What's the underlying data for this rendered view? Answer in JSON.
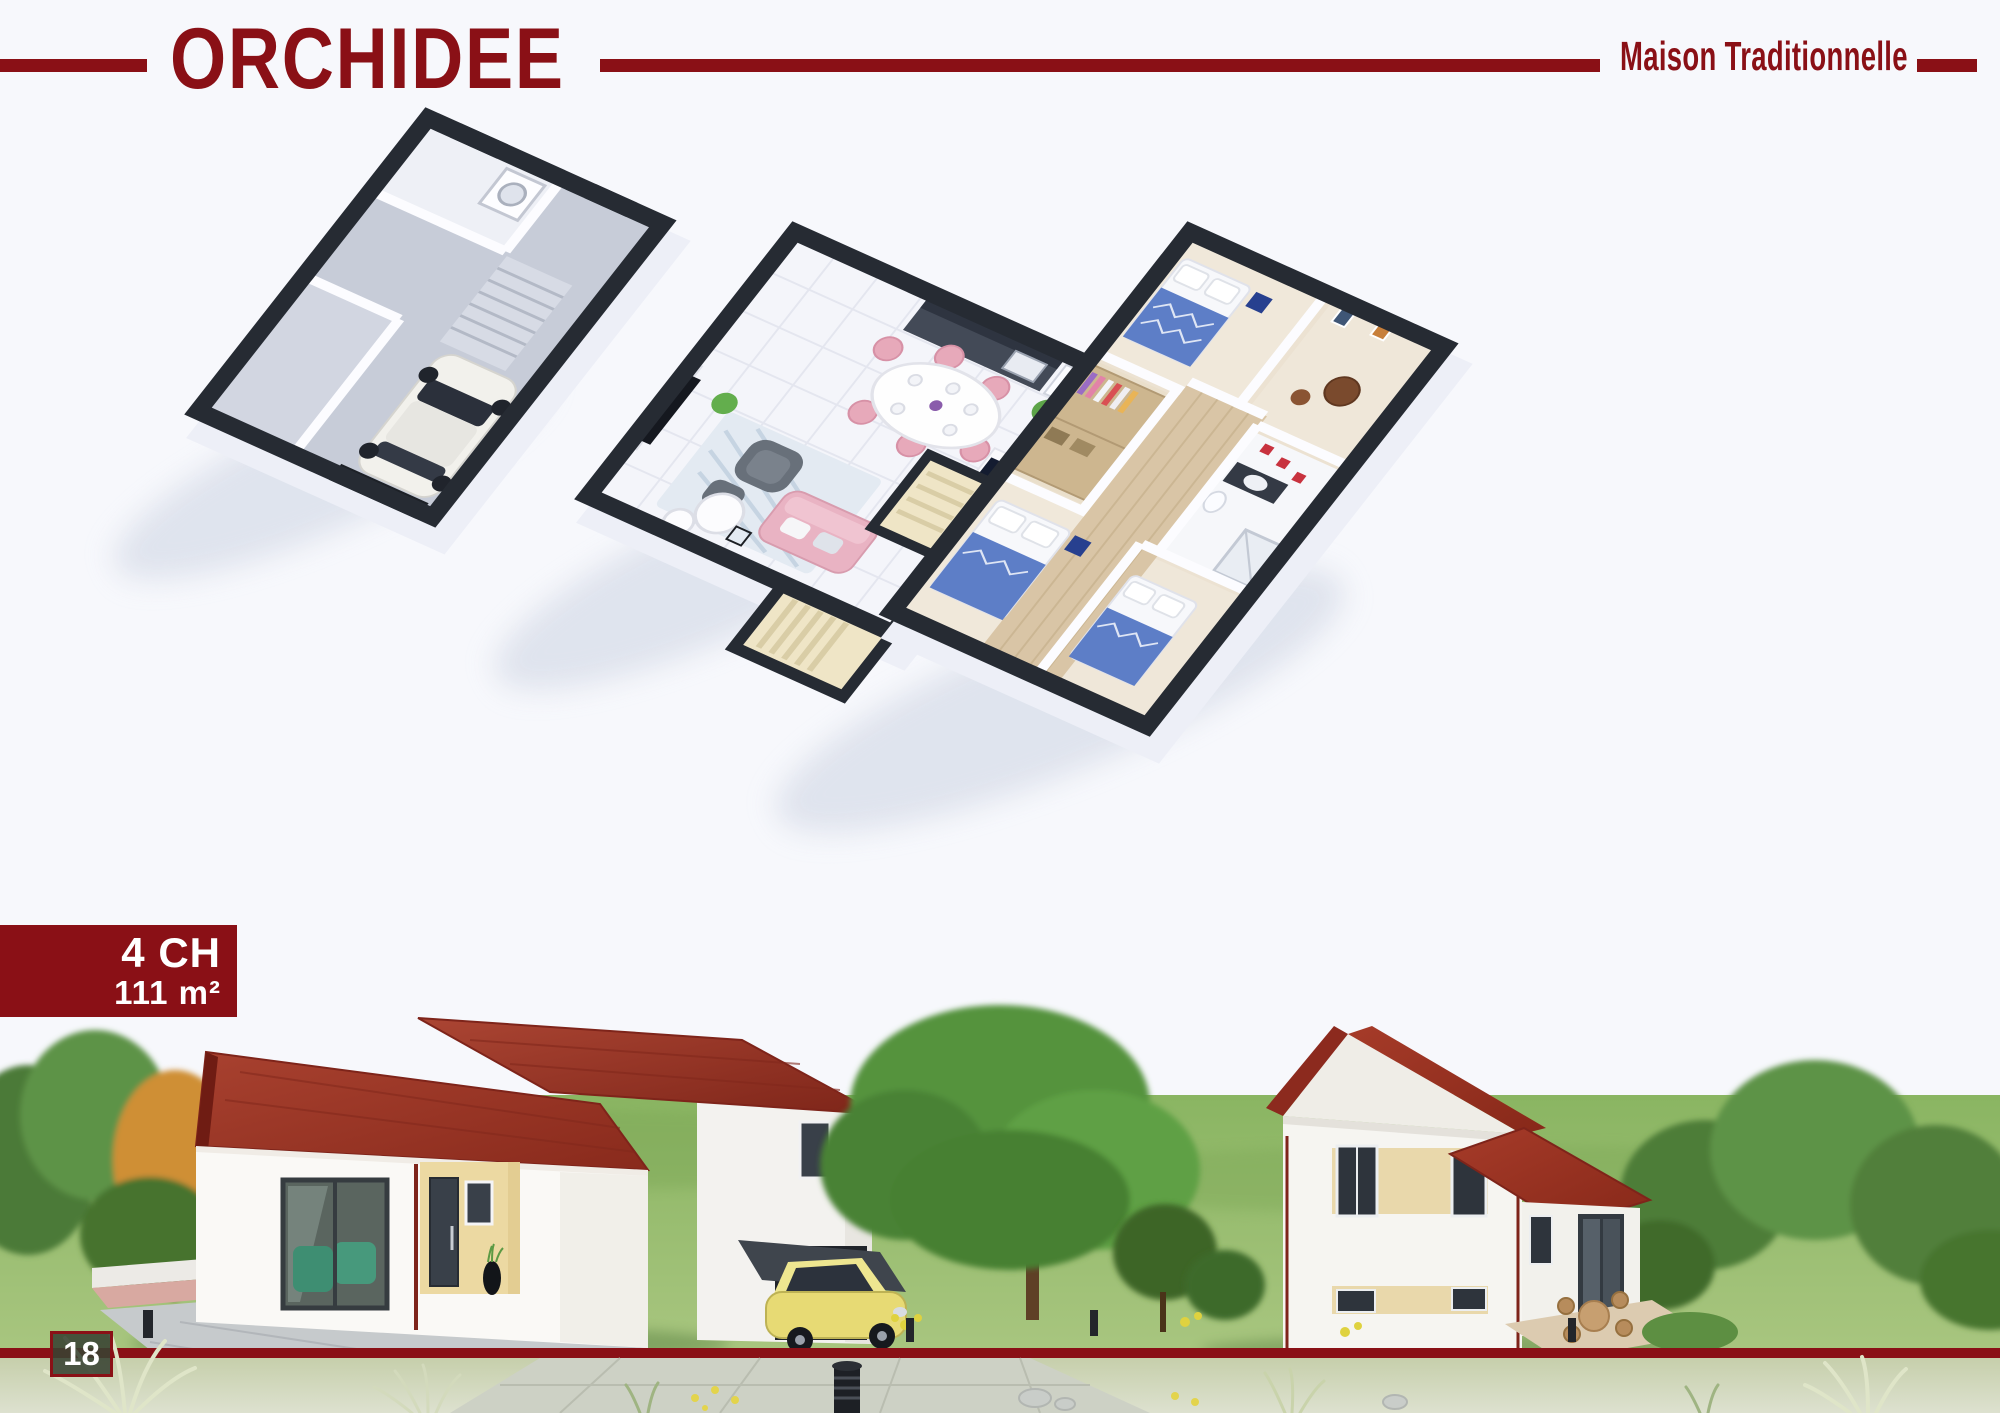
{
  "header": {
    "title": "ORCHIDEE",
    "subtitle": "Maison Traditionnelle"
  },
  "badge": {
    "bedrooms": "4 CH",
    "area": "111 m²"
  },
  "page": {
    "number": "18"
  },
  "colors": {
    "accent": "#8a1016",
    "page-bg": "#f7f8fc",
    "wall-cap-dark": "#262b33",
    "roof-red": "#9c3426",
    "facade-beige": "#ead9ad",
    "grass-green": "#7fb05a"
  },
  "illustrations": {
    "floor_plans": [
      "ground-floor-with-garage",
      "main-living-floor",
      "bedrooms-floor"
    ],
    "exterior_views": [
      "front-street-view",
      "rear-garden-view"
    ]
  }
}
